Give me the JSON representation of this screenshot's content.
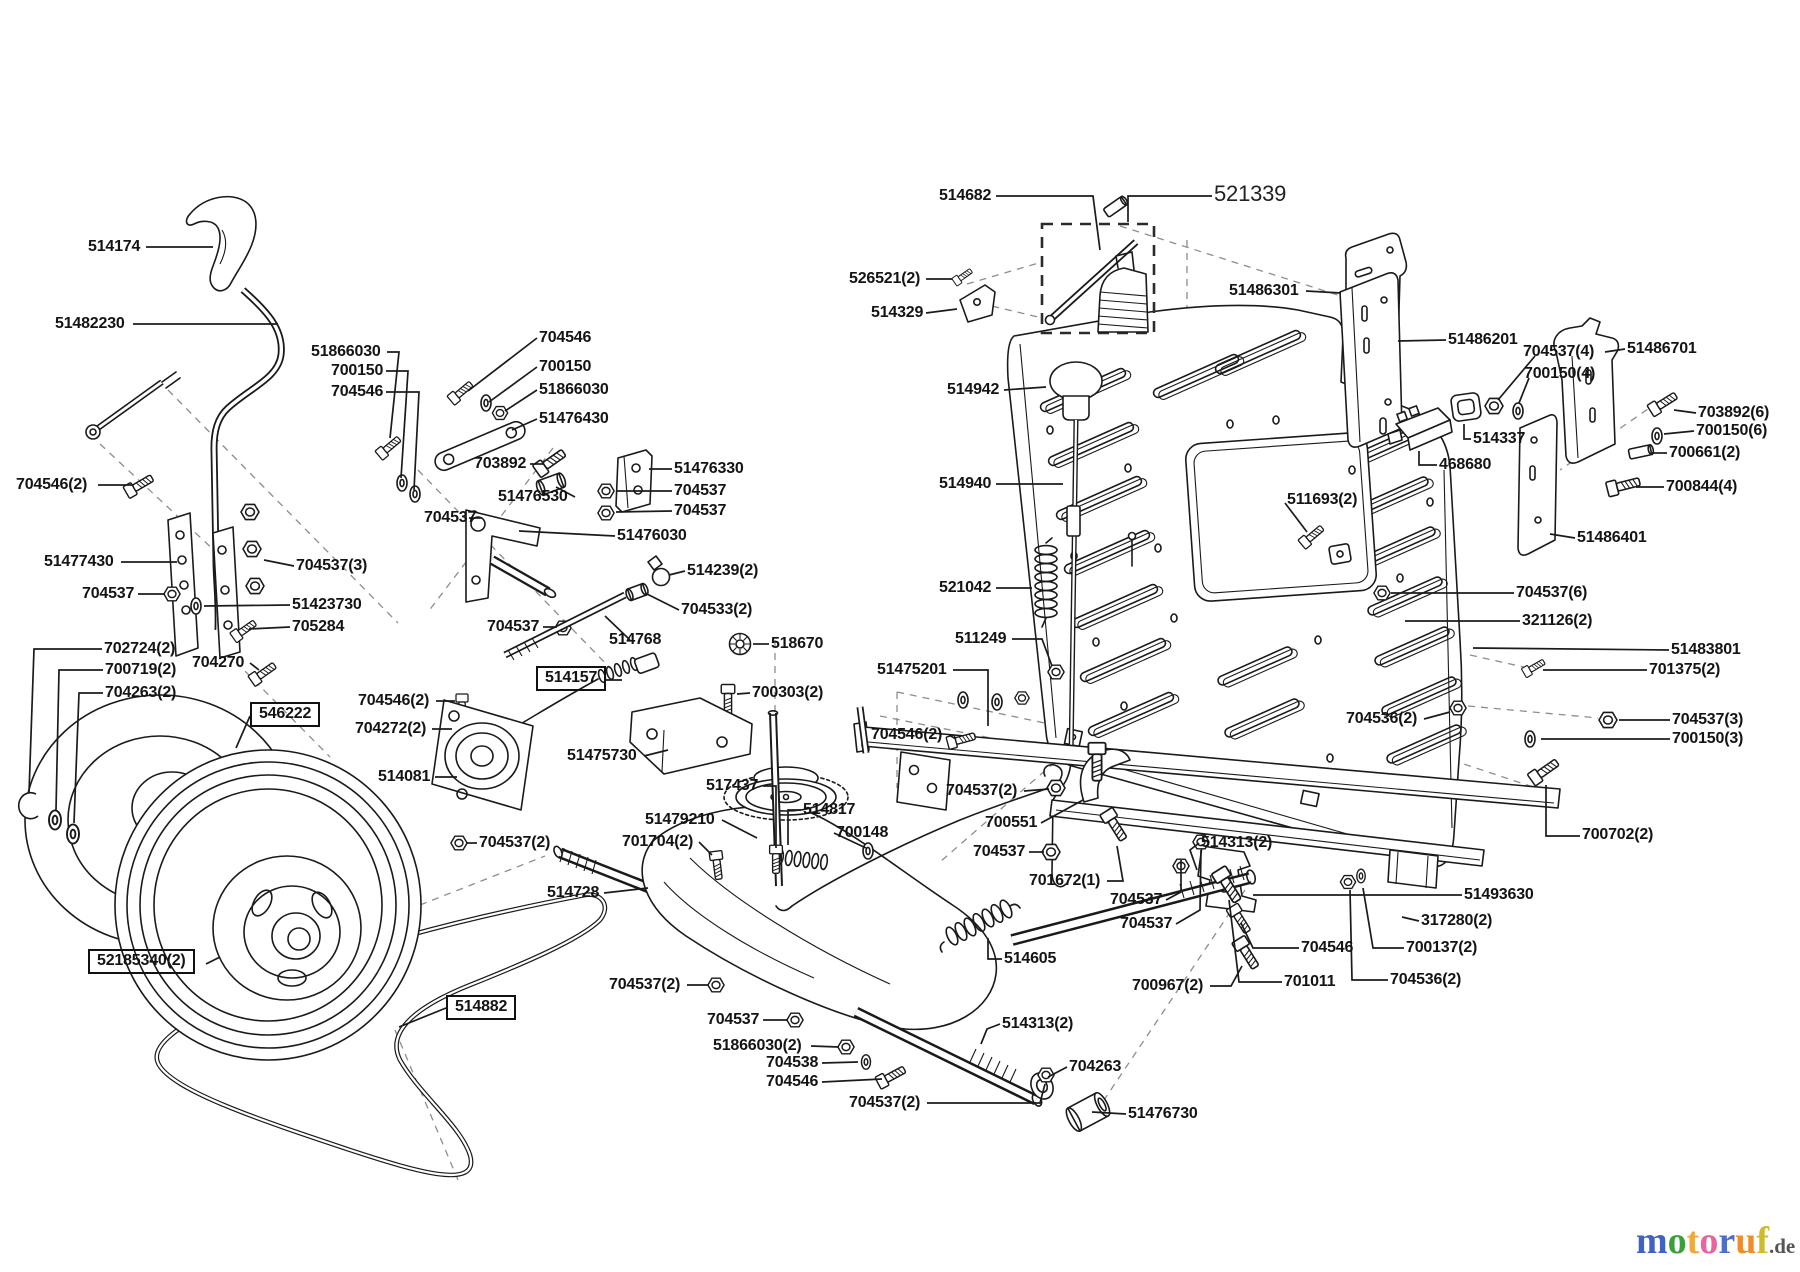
{
  "diagram": {
    "type": "exploded-parts-diagram",
    "description": "Lawn tractor transmission, rear panel and wheel assembly exploded view"
  },
  "logo": {
    "letters": [
      {
        "ch": "m",
        "c": "#3f62c4"
      },
      {
        "ch": "o",
        "c": "#3ba03b"
      },
      {
        "ch": "t",
        "c": "#f2a93b"
      },
      {
        "ch": "o",
        "c": "#e7649e"
      },
      {
        "ch": "r",
        "c": "#4f6ecb"
      },
      {
        "ch": "u",
        "c": "#ef8d2a"
      },
      {
        "ch": "f",
        "c": "#cdbd2e"
      }
    ],
    "suffix": ".de",
    "suffix_color": "#555555"
  },
  "labels": [
    {
      "t": "514174",
      "x": 88,
      "y": 239,
      "l": [
        146,
        247,
        213,
        247
      ]
    },
    {
      "t": "51482230",
      "x": 55,
      "y": 316,
      "l": [
        133,
        324,
        278,
        324
      ]
    },
    {
      "t": "51866030",
      "x": 311,
      "y": 344,
      "l": [
        387,
        352,
        399,
        352,
        390,
        438
      ]
    },
    {
      "t": "700150",
      "x": 331,
      "y": 363,
      "l": [
        386,
        371,
        408,
        371,
        401,
        478
      ]
    },
    {
      "t": "704546",
      "x": 331,
      "y": 384,
      "l": [
        386,
        392,
        419,
        392,
        414,
        490
      ]
    },
    {
      "t": "704546(2)",
      "x": 16,
      "y": 477,
      "l": [
        98,
        485,
        133,
        485
      ]
    },
    {
      "t": "704546",
      "x": 539,
      "y": 330,
      "l": [
        537,
        338,
        468,
        391
      ]
    },
    {
      "t": "700150",
      "x": 539,
      "y": 359,
      "l": [
        537,
        367,
        489,
        402
      ]
    },
    {
      "t": "51866030",
      "x": 539,
      "y": 382,
      "l": [
        537,
        390,
        505,
        411
      ]
    },
    {
      "t": "51476430",
      "x": 539,
      "y": 411,
      "l": [
        537,
        419,
        512,
        430
      ]
    },
    {
      "t": "703892",
      "x": 474,
      "y": 456,
      "l": [
        530,
        464,
        543,
        464
      ]
    },
    {
      "t": "51476330",
      "x": 674,
      "y": 461,
      "l": [
        672,
        469,
        649,
        469
      ]
    },
    {
      "t": "704537",
      "x": 674,
      "y": 483,
      "l": [
        672,
        491,
        616,
        491
      ]
    },
    {
      "t": "704537",
      "x": 674,
      "y": 503,
      "l": [
        672,
        511,
        616,
        512
      ]
    },
    {
      "t": "51476530",
      "x": 498,
      "y": 489,
      "l": [
        575,
        497,
        556,
        487
      ]
    },
    {
      "t": "704537",
      "x": 424,
      "y": 510,
      "l": [
        482,
        518,
        469,
        518
      ]
    },
    {
      "t": "51476030",
      "x": 617,
      "y": 528,
      "l": [
        615,
        536,
        519,
        531
      ]
    },
    {
      "t": "514239(2)",
      "x": 687,
      "y": 563,
      "l": [
        685,
        571,
        669,
        575
      ]
    },
    {
      "t": "704533(2)",
      "x": 681,
      "y": 602,
      "l": [
        679,
        610,
        645,
        593
      ]
    },
    {
      "t": "704537",
      "x": 487,
      "y": 619,
      "l": [
        543,
        627,
        557,
        627
      ]
    },
    {
      "t": "514768",
      "x": 609,
      "y": 632,
      "l": [
        630,
        640,
        605,
        616
      ]
    },
    {
      "t": "518670",
      "x": 771,
      "y": 636,
      "l": [
        769,
        644,
        753,
        644
      ]
    },
    {
      "t": "514157",
      "x": 536,
      "y": 666,
      "b": 1,
      "l": [
        605,
        680,
        622,
        680
      ]
    },
    {
      "t": "700303(2)",
      "x": 752,
      "y": 685,
      "l": [
        750,
        693,
        737,
        694
      ]
    },
    {
      "t": "704546(2)",
      "x": 358,
      "y": 693,
      "l": [
        436,
        701,
        455,
        701
      ]
    },
    {
      "t": "704272(2)",
      "x": 355,
      "y": 721,
      "l": [
        432,
        729,
        452,
        729
      ]
    },
    {
      "t": "51475730",
      "x": 567,
      "y": 748,
      "l": [
        644,
        756,
        668,
        750
      ]
    },
    {
      "t": "514081",
      "x": 378,
      "y": 769,
      "l": [
        435,
        777,
        457,
        777
      ]
    },
    {
      "t": "704537(2)",
      "x": 479,
      "y": 835,
      "l": [
        477,
        843,
        466,
        843
      ]
    },
    {
      "t": "514728",
      "x": 547,
      "y": 885,
      "l": [
        604,
        893,
        648,
        888
      ]
    },
    {
      "t": "517437",
      "x": 706,
      "y": 778,
      "l": [
        763,
        786,
        776,
        786,
        776,
        848
      ]
    },
    {
      "t": "51479210",
      "x": 645,
      "y": 812,
      "l": [
        722,
        820,
        757,
        838
      ]
    },
    {
      "t": "701704(2)",
      "x": 622,
      "y": 834,
      "l": [
        699,
        842,
        712,
        855
      ]
    },
    {
      "t": "514817",
      "x": 803,
      "y": 802,
      "l": [
        801,
        810,
        788,
        810,
        788,
        845
      ]
    },
    {
      "t": "700148",
      "x": 836,
      "y": 825,
      "l": [
        834,
        833,
        866,
        848
      ]
    },
    {
      "t": "702724(2)",
      "x": 104,
      "y": 641,
      "l": [
        102,
        649,
        34,
        649,
        29,
        793
      ]
    },
    {
      "t": "700719(2)",
      "x": 105,
      "y": 662,
      "l": [
        103,
        670,
        59,
        670,
        56,
        810
      ]
    },
    {
      "t": "704263(2)",
      "x": 105,
      "y": 685,
      "l": [
        103,
        693,
        79,
        693,
        74,
        823
      ]
    },
    {
      "t": "704270",
      "x": 192,
      "y": 655,
      "l": [
        250,
        663,
        259,
        670
      ]
    },
    {
      "t": "546222",
      "x": 250,
      "y": 702,
      "b": 1,
      "l": [
        250,
        716,
        236,
        748
      ]
    },
    {
      "t": "51477430",
      "x": 44,
      "y": 554,
      "l": [
        121,
        562,
        177,
        562
      ]
    },
    {
      "t": "704537",
      "x": 82,
      "y": 586,
      "l": [
        138,
        594,
        165,
        594
      ]
    },
    {
      "t": "704537(3)",
      "x": 296,
      "y": 558,
      "l": [
        294,
        566,
        264,
        560
      ]
    },
    {
      "t": "51423730",
      "x": 292,
      "y": 597,
      "l": [
        290,
        605,
        204,
        606
      ]
    },
    {
      "t": "705284",
      "x": 292,
      "y": 619,
      "l": [
        290,
        627,
        249,
        629
      ]
    },
    {
      "t": "52185340(2)",
      "x": 88,
      "y": 949,
      "b": 1,
      "l": [
        206,
        964,
        220,
        957
      ]
    },
    {
      "t": "514882",
      "x": 446,
      "y": 995,
      "b": 1,
      "l": [
        446,
        1008,
        399,
        1027
      ]
    },
    {
      "t": "704537(2)",
      "x": 609,
      "y": 977,
      "l": [
        687,
        985,
        709,
        985
      ]
    },
    {
      "t": "704537",
      "x": 707,
      "y": 1012,
      "l": [
        763,
        1020,
        788,
        1020
      ]
    },
    {
      "t": "51866030(2)",
      "x": 713,
      "y": 1038,
      "l": [
        811,
        1046,
        839,
        1047
      ]
    },
    {
      "t": "704538",
      "x": 766,
      "y": 1055,
      "l": [
        822,
        1063,
        858,
        1062
      ]
    },
    {
      "t": "704546",
      "x": 766,
      "y": 1074,
      "l": [
        822,
        1082,
        882,
        1079
      ]
    },
    {
      "t": "704537(2)",
      "x": 849,
      "y": 1095,
      "l": [
        927,
        1103,
        1040,
        1103,
        1045,
        1084
      ]
    },
    {
      "t": "514313(2)",
      "x": 1002,
      "y": 1016,
      "l": [
        1000,
        1024,
        987,
        1029,
        981,
        1044
      ]
    },
    {
      "t": "704263",
      "x": 1069,
      "y": 1059,
      "l": [
        1067,
        1067,
        1048,
        1077
      ]
    },
    {
      "t": "51476730",
      "x": 1128,
      "y": 1106,
      "l": [
        1126,
        1114,
        1092,
        1112
      ]
    },
    {
      "t": "514605",
      "x": 1004,
      "y": 951,
      "l": [
        1002,
        959,
        988,
        959,
        988,
        938
      ]
    },
    {
      "t": "700967(2)",
      "x": 1132,
      "y": 978,
      "l": [
        1210,
        986,
        1231,
        986,
        1242,
        966
      ]
    },
    {
      "t": "701011",
      "x": 1284,
      "y": 974,
      "l": [
        1282,
        982,
        1239,
        982,
        1229,
        900
      ]
    },
    {
      "t": "704546",
      "x": 1301,
      "y": 940,
      "l": [
        1299,
        948,
        1253,
        948,
        1241,
        923
      ]
    },
    {
      "t": "700137(2)",
      "x": 1406,
      "y": 940,
      "l": [
        1404,
        948,
        1373,
        948,
        1363,
        888
      ]
    },
    {
      "t": "704536(2)",
      "x": 1390,
      "y": 972,
      "l": [
        1388,
        980,
        1352,
        980,
        1350,
        890
      ]
    },
    {
      "t": "317280(2)",
      "x": 1421,
      "y": 913,
      "l": [
        1419,
        921,
        1402,
        917
      ]
    },
    {
      "t": "51493630",
      "x": 1464,
      "y": 887,
      "l": [
        1462,
        895,
        1253,
        895
      ]
    },
    {
      "t": "704537",
      "x": 1110,
      "y": 892,
      "l": [
        1166,
        900,
        1181,
        892,
        1181,
        860
      ]
    },
    {
      "t": "704537",
      "x": 1120,
      "y": 916,
      "l": [
        1176,
        924,
        1200,
        910,
        1201,
        850
      ]
    },
    {
      "t": "701672(1)",
      "x": 1029,
      "y": 873,
      "l": [
        1107,
        881,
        1123,
        881,
        1117,
        846
      ]
    },
    {
      "t": "704537",
      "x": 973,
      "y": 844,
      "l": [
        1029,
        852,
        1044,
        852
      ]
    },
    {
      "t": "700551",
      "x": 985,
      "y": 815,
      "l": [
        1041,
        823,
        1083,
        800
      ]
    },
    {
      "t": "704537(2)",
      "x": 946,
      "y": 783,
      "l": [
        1024,
        791,
        1049,
        789
      ]
    },
    {
      "t": "704546(2)",
      "x": 871,
      "y": 727,
      "l": [
        949,
        735,
        956,
        739
      ]
    },
    {
      "t": "51475201",
      "x": 877,
      "y": 662,
      "l": [
        953,
        670,
        988,
        670,
        988,
        726
      ]
    },
    {
      "t": "511249",
      "x": 955,
      "y": 631,
      "l": [
        1012,
        639,
        1042,
        639,
        1052,
        666
      ]
    },
    {
      "t": "521042",
      "x": 939,
      "y": 580,
      "l": [
        996,
        588,
        1032,
        588
      ]
    },
    {
      "t": "514940",
      "x": 939,
      "y": 476,
      "l": [
        996,
        484,
        1063,
        484
      ]
    },
    {
      "t": "514942",
      "x": 947,
      "y": 382,
      "l": [
        1004,
        390,
        1046,
        387
      ]
    },
    {
      "t": "514682",
      "x": 939,
      "y": 188,
      "l": [
        996,
        196,
        1093,
        196,
        1100,
        250
      ]
    },
    {
      "t": "521339",
      "x": 1214,
      "y": 182,
      "lt": 1,
      "l": [
        1212,
        196,
        1128,
        196,
        1128,
        222
      ]
    },
    {
      "t": "526521(2)",
      "x": 849,
      "y": 271,
      "l": [
        926,
        279,
        952,
        279
      ]
    },
    {
      "t": "514329",
      "x": 871,
      "y": 305,
      "l": [
        926,
        313,
        957,
        309
      ]
    },
    {
      "t": "51486301",
      "x": 1229,
      "y": 283,
      "l": [
        1306,
        291,
        1341,
        293
      ]
    },
    {
      "t": "51486201",
      "x": 1448,
      "y": 332,
      "l": [
        1446,
        340,
        1398,
        341
      ]
    },
    {
      "t": "704537(4)",
      "x": 1523,
      "y": 344,
      "l": [
        1535,
        356,
        1498,
        400
      ]
    },
    {
      "t": "51486701",
      "x": 1627,
      "y": 341,
      "l": [
        1625,
        349,
        1605,
        352
      ]
    },
    {
      "t": "700150(4)",
      "x": 1524,
      "y": 366,
      "l": [
        1529,
        378,
        1519,
        403
      ]
    },
    {
      "t": "703892(6)",
      "x": 1698,
      "y": 405,
      "l": [
        1696,
        413,
        1674,
        410
      ]
    },
    {
      "t": "700150(6)",
      "x": 1696,
      "y": 423,
      "l": [
        1694,
        431,
        1664,
        434
      ]
    },
    {
      "t": "700661(2)",
      "x": 1669,
      "y": 445,
      "l": [
        1667,
        453,
        1652,
        453
      ]
    },
    {
      "t": "700844(4)",
      "x": 1666,
      "y": 479,
      "l": [
        1664,
        487,
        1636,
        487
      ]
    },
    {
      "t": "514337",
      "x": 1473,
      "y": 431,
      "l": [
        1471,
        439,
        1464,
        439,
        1464,
        424
      ]
    },
    {
      "t": "468680",
      "x": 1439,
      "y": 457,
      "l": [
        1437,
        465,
        1419,
        465,
        1419,
        451
      ]
    },
    {
      "t": "51486401",
      "x": 1577,
      "y": 530,
      "l": [
        1575,
        538,
        1550,
        534
      ]
    },
    {
      "t": "511693(2)",
      "x": 1287,
      "y": 492,
      "l": [
        1285,
        503,
        1307,
        532
      ]
    },
    {
      "t": "704537(6)",
      "x": 1516,
      "y": 585,
      "l": [
        1514,
        593,
        1391,
        593
      ]
    },
    {
      "t": "321126(2)",
      "x": 1522,
      "y": 613,
      "l": [
        1520,
        621,
        1405,
        621
      ]
    },
    {
      "t": "51483801",
      "x": 1671,
      "y": 642,
      "l": [
        1669,
        650,
        1473,
        648
      ]
    },
    {
      "t": "701375(2)",
      "x": 1649,
      "y": 662,
      "l": [
        1647,
        670,
        1543,
        670
      ]
    },
    {
      "t": "704536(2)",
      "x": 1346,
      "y": 711,
      "l": [
        1424,
        719,
        1450,
        712
      ]
    },
    {
      "t": "704537(3)",
      "x": 1672,
      "y": 712,
      "l": [
        1670,
        720,
        1619,
        720
      ]
    },
    {
      "t": "700150(3)",
      "x": 1672,
      "y": 731,
      "l": [
        1670,
        739,
        1541,
        739
      ]
    },
    {
      "t": "700702(2)",
      "x": 1582,
      "y": 827,
      "l": [
        1580,
        836,
        1546,
        836,
        1546,
        785
      ]
    },
    {
      "t": "514313(2)",
      "x": 1201,
      "y": 835,
      "l": [
        1199,
        843,
        1190,
        850,
        1197,
        870
      ]
    }
  ]
}
